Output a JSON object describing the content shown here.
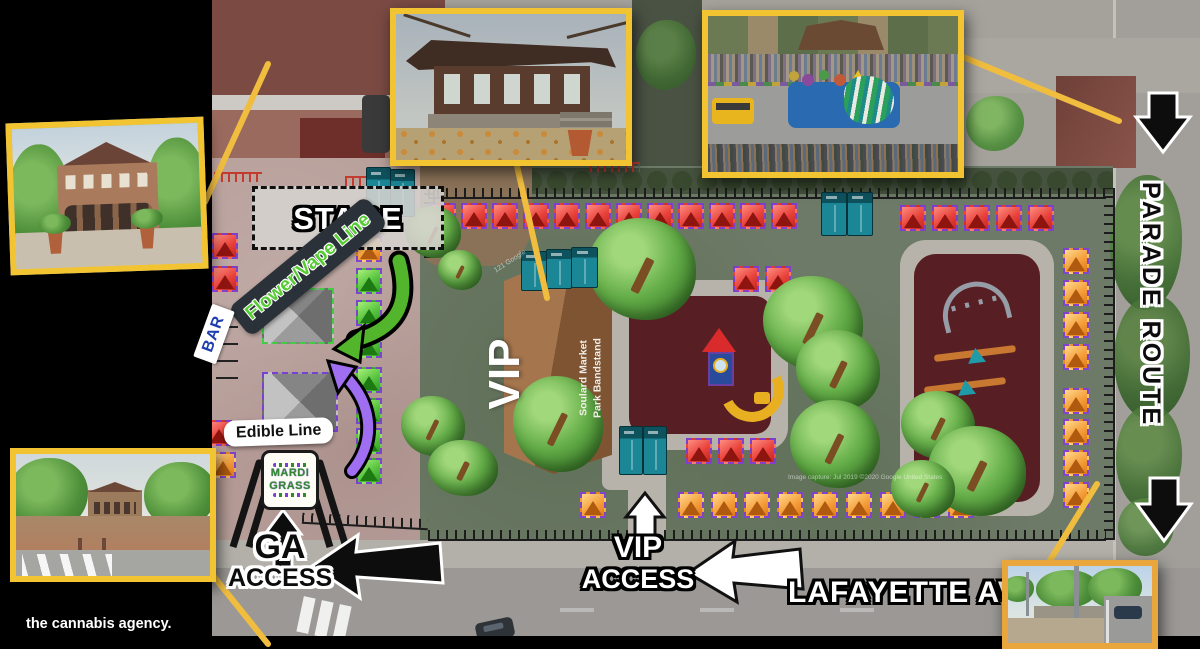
{
  "brand": {
    "credit": "the cannabis agency."
  },
  "labels": {
    "stage": "STAGE",
    "flower_vape": "Flower/Vape Line",
    "bar": "BAR",
    "edible": "Edible Line",
    "ga1": "GA",
    "ga2": "ACCESS",
    "vipa1": "VIP",
    "vipa2": "ACCESS",
    "vip": "VIP",
    "band1": "Soulard Market",
    "band2": "Park Bandstand",
    "lafayette": "LAFAYETTE AVE",
    "parade": "PARADE ROUTE"
  },
  "logo": {
    "l1": "MARDI",
    "l2": "GRASS"
  },
  "watermarks": {
    "w1": "121 Google",
    "w2": "Image capture: Jul 2019   ©2020 Google   United States"
  },
  "colors": {
    "photo_border_yellow": "#f2c431",
    "photo_border_orange": "#e8a63c",
    "park_green": "#6d7a67",
    "plaza_pink": "#b79e99",
    "street_gray": "#9b9895",
    "tent_red": "#e8433b",
    "tent_orange": "#f5a03c",
    "tent_green": "#58c43f",
    "tent_border_purple": "#7a3fd4",
    "playground_maroon": "#571f24",
    "bandstand_brown": "#a5764e",
    "banner_dark": "#2b3138",
    "flower_line_green": "#55cc33",
    "bar_blue": "#1e3fae",
    "curved_arrow_green": "#53b52b",
    "curved_arrow_purple": "#a06ef0"
  },
  "map_elements": {
    "tents": [
      {
        "x": 430,
        "y": 203,
        "c": "red"
      },
      {
        "x": 461,
        "y": 203,
        "c": "red"
      },
      {
        "x": 492,
        "y": 203,
        "c": "red"
      },
      {
        "x": 523,
        "y": 203,
        "c": "red"
      },
      {
        "x": 554,
        "y": 203,
        "c": "red"
      },
      {
        "x": 585,
        "y": 203,
        "c": "red"
      },
      {
        "x": 616,
        "y": 203,
        "c": "red"
      },
      {
        "x": 647,
        "y": 203,
        "c": "red"
      },
      {
        "x": 678,
        "y": 203,
        "c": "red"
      },
      {
        "x": 709,
        "y": 203,
        "c": "red"
      },
      {
        "x": 740,
        "y": 203,
        "c": "red"
      },
      {
        "x": 771,
        "y": 203,
        "c": "red"
      },
      {
        "x": 900,
        "y": 205,
        "c": "red"
      },
      {
        "x": 932,
        "y": 205,
        "c": "red"
      },
      {
        "x": 964,
        "y": 205,
        "c": "red"
      },
      {
        "x": 996,
        "y": 205,
        "c": "red"
      },
      {
        "x": 1028,
        "y": 205,
        "c": "red"
      },
      {
        "x": 733,
        "y": 266,
        "c": "red"
      },
      {
        "x": 765,
        "y": 266,
        "c": "red"
      },
      {
        "x": 686,
        "y": 438,
        "c": "red"
      },
      {
        "x": 718,
        "y": 438,
        "c": "red"
      },
      {
        "x": 750,
        "y": 438,
        "c": "red"
      },
      {
        "x": 212,
        "y": 233,
        "c": "red"
      },
      {
        "x": 212,
        "y": 266,
        "c": "red"
      },
      {
        "x": 206,
        "y": 420,
        "c": "red"
      },
      {
        "x": 210,
        "y": 452,
        "c": "orange"
      },
      {
        "x": 356,
        "y": 236,
        "c": "orange"
      },
      {
        "x": 356,
        "y": 268,
        "c": "green"
      },
      {
        "x": 356,
        "y": 300,
        "c": "green"
      },
      {
        "x": 356,
        "y": 332,
        "c": "green"
      },
      {
        "x": 356,
        "y": 367,
        "c": "green"
      },
      {
        "x": 356,
        "y": 398,
        "c": "green"
      },
      {
        "x": 356,
        "y": 428,
        "c": "green"
      },
      {
        "x": 356,
        "y": 458,
        "c": "green"
      },
      {
        "x": 1063,
        "y": 248,
        "c": "orange"
      },
      {
        "x": 1063,
        "y": 280,
        "c": "orange"
      },
      {
        "x": 1063,
        "y": 312,
        "c": "orange"
      },
      {
        "x": 1063,
        "y": 344,
        "c": "orange"
      },
      {
        "x": 1063,
        "y": 388,
        "c": "orange"
      },
      {
        "x": 1063,
        "y": 419,
        "c": "orange"
      },
      {
        "x": 1063,
        "y": 450,
        "c": "orange"
      },
      {
        "x": 1063,
        "y": 482,
        "c": "orange"
      },
      {
        "x": 580,
        "y": 492,
        "c": "orange"
      },
      {
        "x": 678,
        "y": 492,
        "c": "orange"
      },
      {
        "x": 711,
        "y": 492,
        "c": "orange"
      },
      {
        "x": 744,
        "y": 492,
        "c": "orange"
      },
      {
        "x": 777,
        "y": 492,
        "c": "orange"
      },
      {
        "x": 812,
        "y": 492,
        "c": "orange"
      },
      {
        "x": 846,
        "y": 492,
        "c": "orange"
      },
      {
        "x": 880,
        "y": 492,
        "c": "orange"
      },
      {
        "x": 914,
        "y": 492,
        "c": "orange"
      },
      {
        "x": 948,
        "y": 492,
        "c": "orange"
      }
    ],
    "trees": [
      {
        "x": 405,
        "y": 206,
        "w": 56,
        "h": 52
      },
      {
        "x": 588,
        "y": 218,
        "w": 108,
        "h": 102
      },
      {
        "x": 513,
        "y": 376,
        "w": 90,
        "h": 96
      },
      {
        "x": 401,
        "y": 396,
        "w": 64,
        "h": 60
      },
      {
        "x": 428,
        "y": 440,
        "w": 70,
        "h": 56
      },
      {
        "x": 763,
        "y": 276,
        "w": 100,
        "h": 94
      },
      {
        "x": 796,
        "y": 330,
        "w": 84,
        "h": 80
      },
      {
        "x": 790,
        "y": 400,
        "w": 90,
        "h": 88
      },
      {
        "x": 901,
        "y": 391,
        "w": 74,
        "h": 68
      },
      {
        "x": 928,
        "y": 426,
        "w": 98,
        "h": 90
      },
      {
        "x": 891,
        "y": 460,
        "w": 64,
        "h": 58
      },
      {
        "x": 438,
        "y": 250,
        "w": 44,
        "h": 40
      }
    ],
    "potties": [
      {
        "x": 366,
        "y": 167,
        "w": 23,
        "h": 48
      },
      {
        "x": 390,
        "y": 169,
        "w": 23,
        "h": 46
      },
      {
        "x": 521,
        "y": 251,
        "w": 24,
        "h": 38
      },
      {
        "x": 546,
        "y": 249,
        "w": 24,
        "h": 38
      },
      {
        "x": 571,
        "y": 247,
        "w": 25,
        "h": 39
      },
      {
        "x": 821,
        "y": 192,
        "w": 24,
        "h": 42
      },
      {
        "x": 847,
        "y": 192,
        "w": 24,
        "h": 42
      },
      {
        "x": 619,
        "y": 426,
        "w": 22,
        "h": 47
      },
      {
        "x": 643,
        "y": 426,
        "w": 22,
        "h": 47
      }
    ]
  }
}
